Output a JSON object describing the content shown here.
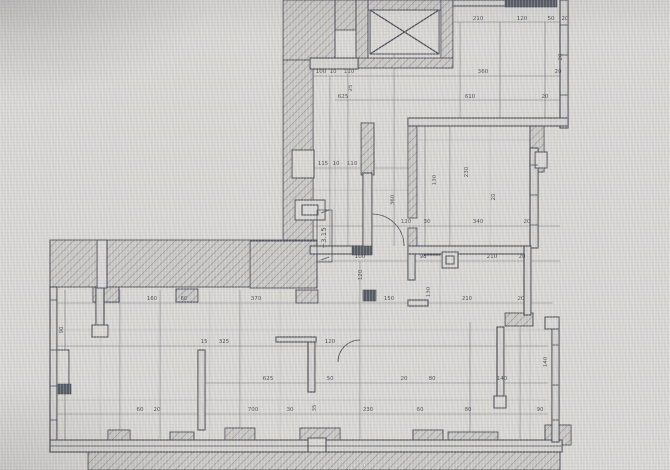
{
  "document": {
    "type": "architectural-floor-plan",
    "level_marker": {
      "text": "+3.15",
      "x": 326,
      "y": 238
    }
  },
  "colors": {
    "paper": "#d9d7d3",
    "wall_fill": "#d4d2ce",
    "line": "#474b56",
    "dim": "#73767e",
    "faint": "#adafb4",
    "hatch_fill": "#cac8c4",
    "hatch_line": "#8a8d96",
    "dark": "#585c65",
    "text": "#4b4e57"
  },
  "drawing": {
    "hatched_walls": [
      [
        283,
        0,
        52,
        60
      ],
      [
        283,
        60,
        30,
        188
      ],
      [
        335,
        0,
        21,
        30
      ],
      [
        356,
        0,
        97,
        10
      ],
      [
        356,
        0,
        12,
        68
      ],
      [
        441,
        0,
        12,
        68
      ],
      [
        356,
        58,
        97,
        10
      ],
      [
        530,
        120,
        14,
        52
      ],
      [
        408,
        122,
        9,
        96
      ],
      [
        408,
        228,
        9,
        24
      ],
      [
        361,
        123,
        13,
        52
      ],
      [
        424,
        246,
        16,
        9
      ],
      [
        50,
        240,
        267,
        47
      ],
      [
        250,
        241,
        67,
        47
      ],
      [
        93,
        287,
        26,
        15
      ],
      [
        176,
        289,
        22,
        13
      ],
      [
        296,
        290,
        22,
        13
      ],
      [
        505,
        313,
        28,
        13
      ],
      [
        108,
        430,
        22,
        16
      ],
      [
        170,
        432,
        24,
        14
      ],
      [
        225,
        428,
        30,
        16
      ],
      [
        300,
        428,
        40,
        36
      ],
      [
        413,
        430,
        30,
        18
      ],
      [
        448,
        432,
        50,
        26
      ],
      [
        545,
        425,
        26,
        20
      ],
      [
        88,
        452,
        472,
        18
      ]
    ],
    "thin_walls": [
      [
        560,
        0,
        8,
        128
      ],
      [
        453,
        0,
        59,
        6
      ],
      [
        310,
        58,
        48,
        11
      ],
      [
        408,
        118,
        160,
        8
      ],
      [
        530,
        148,
        8,
        100
      ],
      [
        310,
        246,
        62,
        8
      ],
      [
        408,
        246,
        118,
        8
      ],
      [
        524,
        246,
        7,
        69
      ],
      [
        408,
        254,
        7,
        26
      ],
      [
        408,
        300,
        20,
        6
      ],
      [
        50,
        287,
        7,
        165
      ],
      [
        50,
        440,
        512,
        12
      ],
      [
        552,
        317,
        7,
        125
      ],
      [
        198,
        350,
        7,
        80
      ],
      [
        308,
        340,
        7,
        52
      ],
      [
        276,
        337,
        40,
        5
      ],
      [
        497,
        327,
        7,
        75
      ],
      [
        363,
        173,
        9,
        74
      ],
      [
        96,
        287,
        8,
        40
      ]
    ],
    "white_details": [
      [
        370,
        10,
        69,
        44
      ],
      [
        292,
        150,
        22,
        28
      ],
      [
        295,
        200,
        30,
        20
      ],
      [
        302,
        205,
        16,
        10
      ],
      [
        97,
        240,
        10,
        48
      ],
      [
        57,
        350,
        12,
        36
      ],
      [
        92,
        325,
        16,
        12
      ],
      [
        442,
        252,
        16,
        16
      ],
      [
        446,
        256,
        8,
        8
      ],
      [
        535,
        152,
        12,
        16
      ],
      [
        545,
        317,
        14,
        12
      ],
      [
        494,
        396,
        12,
        12
      ],
      [
        308,
        438,
        18,
        14
      ]
    ],
    "solid_blocks": [
      [
        505,
        0,
        52,
        7
      ],
      [
        352,
        246,
        20,
        9
      ],
      [
        363,
        290,
        13,
        11
      ],
      [
        57,
        384,
        14,
        10
      ]
    ],
    "detail_lines": [
      [
        560,
        25,
        568,
        25
      ],
      [
        560,
        55,
        568,
        55
      ],
      [
        560,
        95,
        568,
        95
      ],
      [
        530,
        165,
        538,
        165
      ],
      [
        530,
        195,
        538,
        195
      ],
      [
        530,
        225,
        538,
        225
      ],
      [
        50,
        300,
        57,
        300
      ],
      [
        50,
        350,
        57,
        350
      ],
      [
        50,
        386,
        57,
        386
      ],
      [
        50,
        420,
        57,
        420
      ],
      [
        50,
        446,
        562,
        446
      ],
      [
        552,
        345,
        559,
        345
      ],
      [
        552,
        385,
        559,
        385
      ],
      [
        552,
        420,
        559,
        420
      ]
    ],
    "cross_lines": [
      [
        370,
        10,
        439,
        54
      ],
      [
        439,
        10,
        370,
        54
      ]
    ],
    "dim_lines": [
      [
        450,
        22,
        568,
        22
      ],
      [
        313,
        76,
        568,
        76
      ],
      [
        335,
        100,
        560,
        100
      ],
      [
        313,
        168,
        412,
        168
      ],
      [
        313,
        226,
        560,
        226
      ],
      [
        313,
        261,
        560,
        261
      ],
      [
        57,
        303,
        553,
        303
      ],
      [
        57,
        346,
        548,
        346
      ],
      [
        198,
        383,
        548,
        383
      ],
      [
        57,
        414,
        548,
        414
      ],
      [
        330,
        76,
        330,
        246
      ],
      [
        348,
        60,
        348,
        246
      ],
      [
        394,
        30,
        394,
        246
      ],
      [
        460,
        22,
        460,
        118
      ],
      [
        500,
        22,
        500,
        118
      ],
      [
        545,
        22,
        545,
        118
      ],
      [
        425,
        126,
        425,
        246
      ],
      [
        450,
        126,
        450,
        246
      ],
      [
        120,
        290,
        120,
        440
      ],
      [
        160,
        290,
        160,
        440
      ],
      [
        240,
        290,
        240,
        440
      ],
      [
        360,
        261,
        360,
        440
      ],
      [
        470,
        322,
        470,
        440
      ],
      [
        520,
        322,
        520,
        440
      ],
      [
        65,
        290,
        65,
        440
      ]
    ],
    "faint_lines": [
      [
        418,
        140,
        530,
        140
      ],
      [
        313,
        190,
        412,
        190
      ],
      [
        57,
        330,
        548,
        330
      ],
      [
        57,
        400,
        548,
        400
      ],
      [
        210,
        290,
        210,
        440
      ],
      [
        280,
        290,
        280,
        440
      ],
      [
        440,
        250,
        440,
        313
      ],
      [
        490,
        126,
        490,
        246
      ],
      [
        370,
        60,
        370,
        246
      ],
      [
        530,
        322,
        530,
        440
      ],
      [
        335,
        130,
        335,
        246
      ],
      [
        100,
        290,
        100,
        440
      ]
    ],
    "door_arcs": [
      "M 404 246 A 32 32 0 0 0 372 214",
      "M 338 362 A 22 22 0 0 1 360 340"
    ],
    "dim_labels": [
      [
        "210",
        478,
        20,
        0
      ],
      [
        "120",
        522,
        20,
        0
      ],
      [
        "50",
        551,
        20,
        0
      ],
      [
        "20",
        565,
        20,
        0
      ],
      [
        "100",
        321,
        73,
        0
      ],
      [
        "10",
        333,
        73,
        0
      ],
      [
        "110",
        349,
        73,
        0
      ],
      [
        "360",
        483,
        73,
        0
      ],
      [
        "20",
        558,
        73,
        0
      ],
      [
        "625",
        343,
        98,
        0
      ],
      [
        "610",
        470,
        98,
        0
      ],
      [
        "20",
        545,
        98,
        0
      ],
      [
        "115",
        323,
        165,
        0
      ],
      [
        "10",
        336,
        165,
        0
      ],
      [
        "110",
        352,
        165,
        0
      ],
      [
        "120",
        406,
        223,
        0
      ],
      [
        "30",
        427,
        223,
        0
      ],
      [
        "340",
        478,
        223,
        0
      ],
      [
        "20",
        527,
        223,
        0
      ],
      [
        "100",
        360,
        258,
        0
      ],
      [
        "98",
        423,
        258,
        0
      ],
      [
        "210",
        492,
        258,
        0
      ],
      [
        "20",
        522,
        258,
        0
      ],
      [
        "160",
        152,
        300,
        0
      ],
      [
        "60",
        184,
        300,
        0
      ],
      [
        "370",
        256,
        300,
        0
      ],
      [
        "150",
        389,
        300,
        0
      ],
      [
        "210",
        467,
        300,
        0
      ],
      [
        "20",
        521,
        300,
        0
      ],
      [
        "15",
        204,
        343,
        0
      ],
      [
        "325",
        224,
        343,
        0
      ],
      [
        "120",
        330,
        343,
        0
      ],
      [
        "625",
        268,
        380,
        0
      ],
      [
        "50",
        330,
        380,
        0
      ],
      [
        "20",
        404,
        380,
        0
      ],
      [
        "80",
        432,
        380,
        0
      ],
      [
        "140",
        502,
        380,
        0
      ],
      [
        "60",
        140,
        411,
        0
      ],
      [
        "20",
        157,
        411,
        0
      ],
      [
        "700",
        253,
        411,
        0
      ],
      [
        "30",
        290,
        411,
        0
      ],
      [
        "230",
        368,
        411,
        0
      ],
      [
        "60",
        420,
        411,
        0
      ],
      [
        "80",
        468,
        411,
        0
      ],
      [
        "90",
        540,
        411,
        0
      ],
      [
        "25",
        352,
        88,
        -90
      ],
      [
        "230",
        468,
        172,
        -90
      ],
      [
        "20",
        495,
        197,
        -90
      ],
      [
        "130",
        430,
        292,
        -90
      ],
      [
        "120",
        362,
        275,
        -90
      ],
      [
        "360",
        394,
        200,
        -90
      ],
      [
        "90",
        63,
        330,
        -90
      ],
      [
        "140",
        547,
        362,
        -90
      ],
      [
        "35",
        316,
        408,
        -90
      ],
      [
        "20",
        562,
        57,
        -90
      ],
      [
        "130",
        436,
        180,
        -90
      ]
    ],
    "level_box": [
      317,
      210,
      15,
      52
    ]
  }
}
